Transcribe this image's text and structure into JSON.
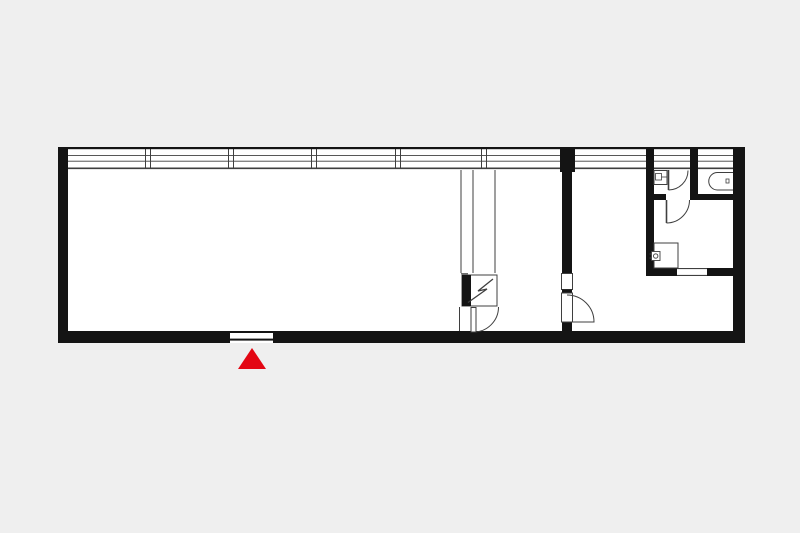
{
  "colors": {
    "background": "#efefef",
    "floor": "#ffffff",
    "wall": "#141414",
    "line": "#3f3f3f",
    "accent_red": "#e30613"
  },
  "plan": {
    "kind": "floor-plan",
    "entrance": {
      "marker_icon": "entrance-arrow-icon",
      "marker_shape": "red-triangle-pointing-up"
    },
    "fixtures": [
      {
        "icon": "window-band-icon"
      },
      {
        "icon": "entrance-opening-icon"
      },
      {
        "icon": "interior-door-swing-icon"
      },
      {
        "icon": "bathroom-door-swing-icon"
      },
      {
        "icon": "wc-door-swing-icon"
      },
      {
        "icon": "utility-door-swing-icon"
      },
      {
        "icon": "toilet-icon"
      },
      {
        "icon": "washbasin-icon"
      },
      {
        "icon": "stove-icon"
      },
      {
        "icon": "kitchen-counter-icon"
      },
      {
        "icon": "electrical-cabinet-icon"
      },
      {
        "icon": "duct-shaft-icon"
      },
      {
        "icon": "threshold-opening-icon"
      }
    ]
  }
}
